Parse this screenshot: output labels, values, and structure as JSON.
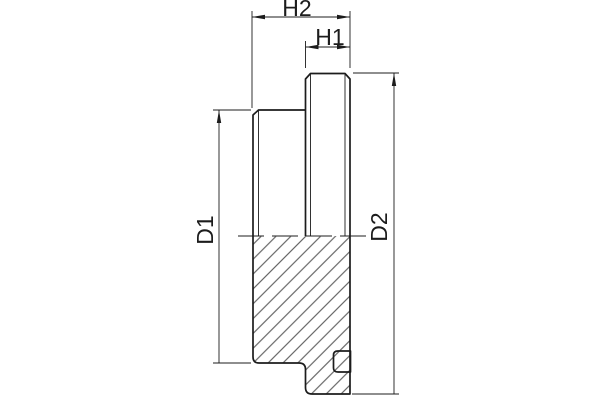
{
  "drawing": {
    "dimension_labels": {
      "h2": "H2",
      "h1": "H1",
      "d1": "D1",
      "d2": "D2"
    },
    "colors": {
      "line": "#1c1c1c",
      "hatch": "#4a4a4a",
      "background": "#ffffff"
    }
  }
}
